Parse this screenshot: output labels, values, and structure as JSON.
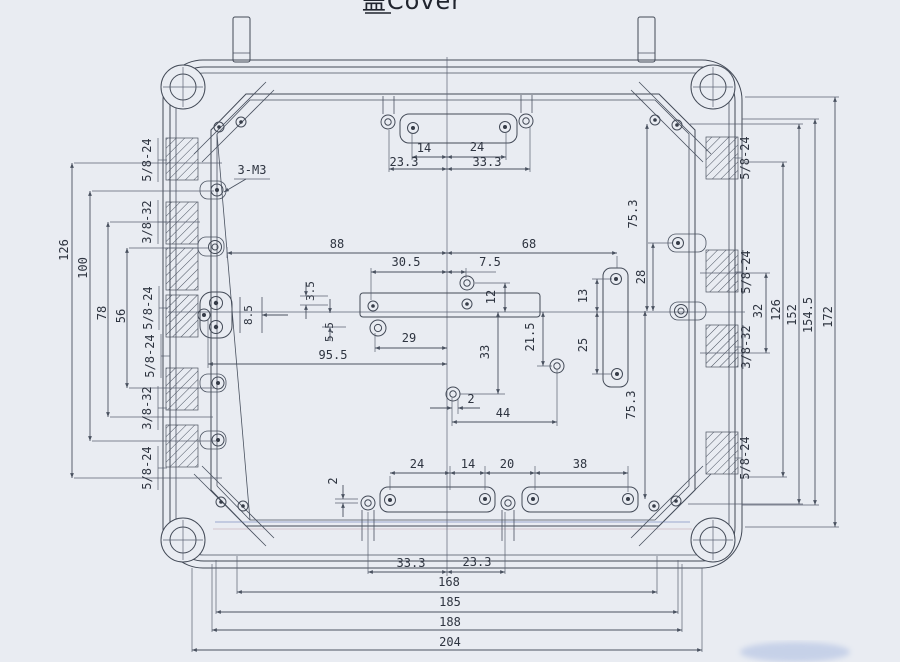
{
  "title": "盖Cover",
  "callout_3m3": "3-M3",
  "threads": {
    "left": [
      "5/8-24",
      "3/8-32",
      "5/8-24",
      "5/8-24",
      "3/8-32",
      "5/8-24"
    ],
    "right": [
      "5/8-24",
      "5/8-24",
      "3/8-32",
      "5/8-24"
    ]
  },
  "dims": {
    "top_slot": {
      "s14": "14",
      "s24": "24",
      "s233": "23.3",
      "s333": "33.3"
    },
    "horizontal": {
      "d88": "88",
      "d68": "68",
      "d305": "30.5",
      "d75": "7.5",
      "d29": "29",
      "d955": "95.5",
      "d44": "44",
      "d2": "2"
    },
    "vertical_mid": {
      "d35": "3.5",
      "d55": "5.5",
      "d85": "8.5",
      "d12": "12",
      "d33": "33",
      "d215": "21.5",
      "d13": "13",
      "d25": "25",
      "d28": "28",
      "d753_upper": "75.3",
      "d753_lower": "75.3"
    },
    "left_stack": {
      "d126": "126",
      "d100": "100",
      "d78": "78",
      "d56": "56"
    },
    "right_stack": {
      "d32": "32",
      "d126": "126",
      "d152": "152",
      "d1545": "154.5",
      "d172": "172"
    },
    "bottom_slot": {
      "s24": "24",
      "s14": "14",
      "s20": "20",
      "s38": "38",
      "s2": "2",
      "s333": "33.3",
      "s233": "23.3"
    },
    "bottom_stack": {
      "d168": "168",
      "d185": "185",
      "d188": "188",
      "d204": "204"
    }
  }
}
